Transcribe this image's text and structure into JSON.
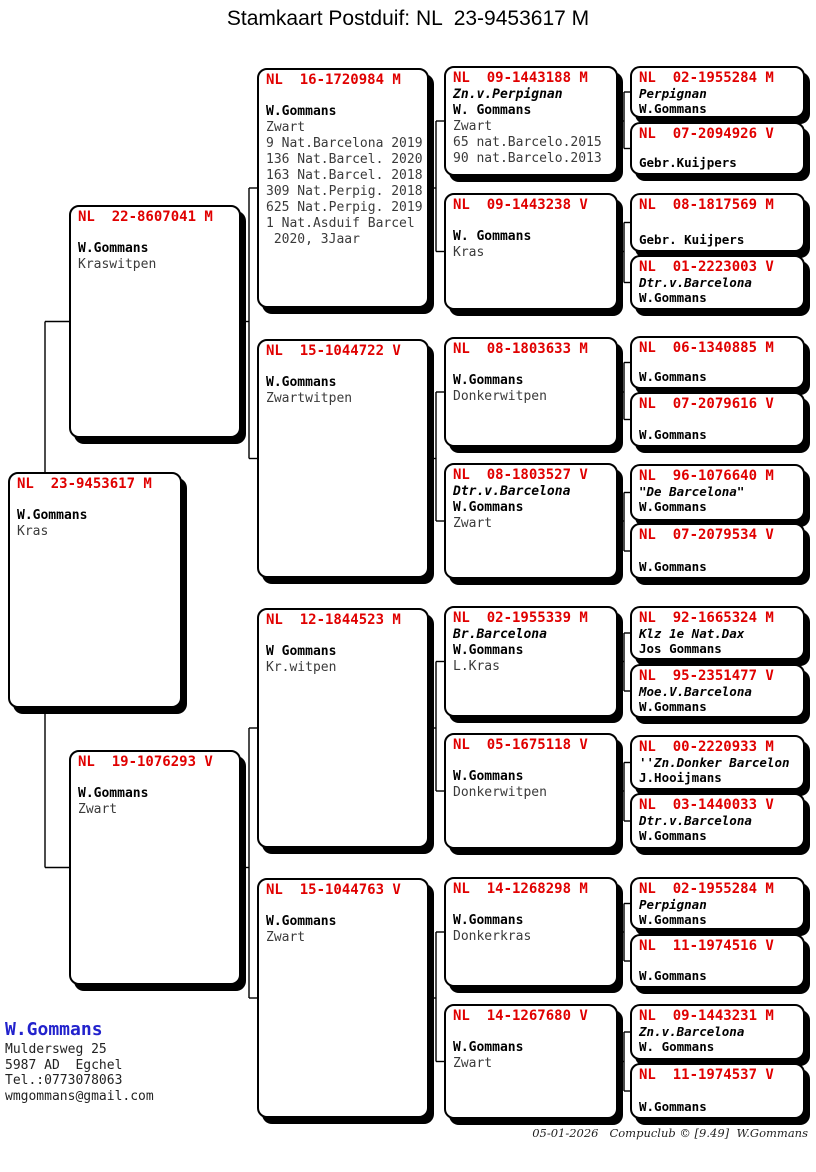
{
  "title": "Stamkaart Postduif: NL  23-9453617 M",
  "colors": {
    "ring_number_red": "#e00000",
    "breeder_name_blue": "#2222cc"
  },
  "pigeons": [
    {
      "id": "subject",
      "gen": 1,
      "ring": "NL  23-9453617 M",
      "owner": "W.Gommans",
      "details": [
        "Kras"
      ]
    },
    {
      "id": "father",
      "gen": 2,
      "ring": "NL  22-8607041 M",
      "owner": "W.Gommans",
      "details": [
        "Kraswitpen"
      ]
    },
    {
      "id": "mother",
      "gen": 2,
      "ring": "NL  19-1076293 V",
      "owner": "W.Gommans",
      "details": [
        "Zwart"
      ]
    },
    {
      "id": "ff",
      "gen": 3,
      "ring": "NL  16-1720984 M",
      "owner": "W.Gommans",
      "details": [
        "Zwart",
        "9 Nat.Barcelona 2019",
        "136 Nat.Barcel. 2020",
        "163 Nat.Barcel. 2018",
        "309 Nat.Perpig. 2018",
        "625 Nat.Perpig. 2019",
        "1 Nat.Asduif Barcel",
        " 2020, 3Jaar"
      ]
    },
    {
      "id": "fm",
      "gen": 3,
      "ring": "NL  15-1044722 V",
      "owner": "W.Gommans",
      "details": [
        "Zwartwitpen"
      ]
    },
    {
      "id": "mf",
      "gen": 3,
      "ring": "NL  12-1844523 M",
      "owner": "W Gommans",
      "details": [
        "Kr.witpen"
      ]
    },
    {
      "id": "mm",
      "gen": 3,
      "ring": "NL  15-1044763 V",
      "owner": "W.Gommans",
      "details": [
        "Zwart"
      ]
    },
    {
      "id": "fff",
      "gen": 4,
      "ring": "NL  09-1443188 M",
      "nickname": "Zn.v.Perpignan",
      "owner": "W. Gommans",
      "details": [
        "Zwart",
        "65 nat.Barcelo.2015",
        "90 nat.Barcelo.2013"
      ]
    },
    {
      "id": "ffm",
      "gen": 4,
      "ring": "NL  09-1443238 V",
      "owner": "W. Gommans",
      "details": [
        "Kras"
      ]
    },
    {
      "id": "fmf",
      "gen": 4,
      "ring": "NL  08-1803633 M",
      "owner": "W.Gommans",
      "details": [
        "Donkerwitpen"
      ]
    },
    {
      "id": "fmm",
      "gen": 4,
      "ring": "NL  08-1803527 V",
      "nickname": "Dtr.v.Barcelona",
      "owner": "W.Gommans",
      "details": [
        "Zwart"
      ]
    },
    {
      "id": "mff",
      "gen": 4,
      "ring": "NL  02-1955339 M",
      "nickname": "Br.Barcelona",
      "owner": "W.Gommans",
      "details": [
        "L.Kras"
      ]
    },
    {
      "id": "mfm",
      "gen": 4,
      "ring": "NL  05-1675118 V",
      "owner": "W.Gommans",
      "details": [
        "Donkerwitpen"
      ]
    },
    {
      "id": "mmf",
      "gen": 4,
      "ring": "NL  14-1268298 M",
      "owner": "W.Gommans",
      "details": [
        "Donkerkras"
      ]
    },
    {
      "id": "mmm",
      "gen": 4,
      "ring": "NL  14-1267680 V",
      "owner": "W.Gommans",
      "details": [
        "Zwart"
      ]
    },
    {
      "id": "ffff",
      "gen": 5,
      "ring": "NL  02-1955284 M",
      "nickname": "Perpignan",
      "owner": "W.Gommans",
      "details": []
    },
    {
      "id": "fffm",
      "gen": 5,
      "ring": "NL  07-2094926 V",
      "owner": "Gebr.Kuijpers",
      "details": []
    },
    {
      "id": "ffmf",
      "gen": 5,
      "ring": "NL  08-1817569 M",
      "owner": "Gebr. Kuijpers",
      "details": []
    },
    {
      "id": "ffmm",
      "gen": 5,
      "ring": "NL  01-2223003 V",
      "nickname": "Dtr.v.Barcelona",
      "owner": "W.Gommans",
      "details": []
    },
    {
      "id": "fmff",
      "gen": 5,
      "ring": "NL  06-1340885 M",
      "owner": "W.Gommans",
      "details": []
    },
    {
      "id": "fmfm",
      "gen": 5,
      "ring": "NL  07-2079616 V",
      "owner": "W.Gommans",
      "details": []
    },
    {
      "id": "fmmf",
      "gen": 5,
      "ring": "NL  96-1076640 M",
      "nickname": "\"De Barcelona\"",
      "owner": "W.Gommans",
      "details": []
    },
    {
      "id": "fmmm",
      "gen": 5,
      "ring": "NL  07-2079534 V",
      "owner": "W.Gommans",
      "details": []
    },
    {
      "id": "mfff",
      "gen": 5,
      "ring": "NL  92-1665324 M",
      "nickname": "Klz 1e Nat.Dax",
      "owner": "Jos Gommans",
      "details": []
    },
    {
      "id": "mffm",
      "gen": 5,
      "ring": "NL  95-2351477 V",
      "nickname": "Moe.V.Barcelona",
      "owner": "W.Gommans",
      "details": []
    },
    {
      "id": "mfmf",
      "gen": 5,
      "ring": "NL  00-2220933 M",
      "nickname": "''Zn.Donker Barcelon",
      "owner": "J.Hooijmans",
      "details": []
    },
    {
      "id": "mfmm",
      "gen": 5,
      "ring": "NL  03-1440033 V",
      "nickname": "Dtr.v.Barcelona",
      "owner": "W.Gommans",
      "details": []
    },
    {
      "id": "mmff",
      "gen": 5,
      "ring": "NL  02-1955284 M",
      "nickname": "Perpignan",
      "owner": "W.Gommans",
      "details": []
    },
    {
      "id": "mmfm",
      "gen": 5,
      "ring": "NL  11-1974516 V",
      "owner": "W.Gommans",
      "details": []
    },
    {
      "id": "mmmf",
      "gen": 5,
      "ring": "NL  09-1443231 M",
      "nickname": "Zn.v.Barcelona",
      "owner": "W. Gommans",
      "details": []
    },
    {
      "id": "mmmm",
      "gen": 5,
      "ring": "NL  11-1974537 V",
      "owner": "W.Gommans",
      "details": []
    }
  ],
  "breeder": {
    "name": "W.Gommans",
    "lines": [
      "Muldersweg 25",
      "5987 AD  Egchel",
      "Tel.:0773078063",
      "wmgommans@gmail.com"
    ]
  },
  "footer": {
    "text": "05-01-2026   Compuclub © [9.49]  W.Gommans"
  }
}
